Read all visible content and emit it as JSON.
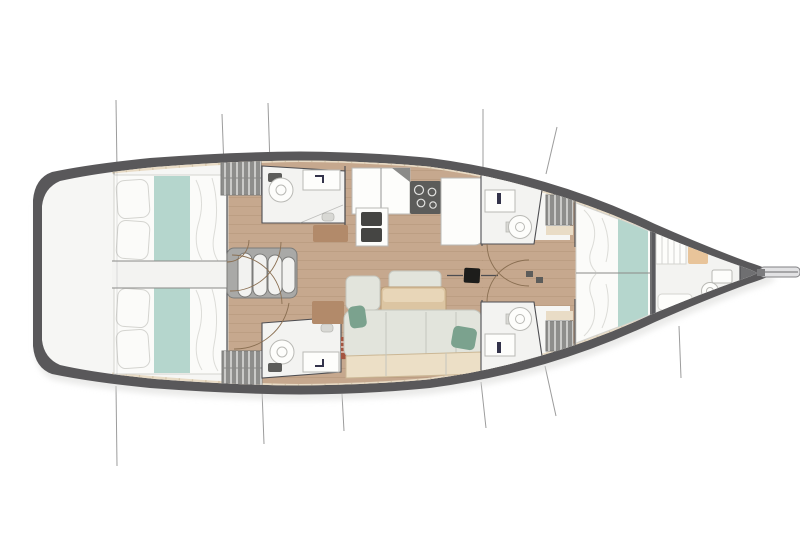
{
  "diagram": {
    "type": "yacht-deck-plan",
    "orientation": "bow-right",
    "regions": [
      "cockpit-stern-platform",
      "aft-cabin-port-double-bed",
      "aft-cabin-starboard-double-bed",
      "stern-corridor",
      "companionway-steps",
      "aft-head-port",
      "aft-head-starboard",
      "hanging-locker-aft-port",
      "hanging-locker-aft-starboard",
      "galley-with-stove-and-sinks",
      "saloon-dinette-table-settee",
      "mast-step",
      "forward-head-port",
      "forward-head-starboard",
      "hanging-locker-forward-port",
      "hanging-locker-forward-starboard",
      "owner-cabin-v-berth",
      "forepeak-crew-cabin",
      "bowsprit",
      "rigging-shroud-lines"
    ]
  },
  "colors": {
    "background": "#ffffff",
    "rigging": "#9c9c9c",
    "shadow": "#d9d9d7",
    "hull": "#59585a",
    "deck": "#f6f6f4",
    "bow_wedge": "#6f6f71",
    "wood_floor": "#c6a88e",
    "wood_plank": "#a98c70",
    "deck_trim": "#e9dcc6",
    "deck_trim_seam": "#cdbb9e",
    "wall": "#4e4e52",
    "bulkhead_light": "#8a8a88",
    "bed_white": "#fbfbf9",
    "bed_outline": "#d4d4d0",
    "runner_teal": "#b5d6cd",
    "pillow_teal": "#7ba28e",
    "fixture_room": "#f3f3f1",
    "fixture_white": "#fdfdfb",
    "fixture_outline": "#b9b9b5",
    "sink_dark": "#454543",
    "stove_dark": "#5c5c5a",
    "steps_outer": "#a9a9a7",
    "steps_inner": "#f2f2f0",
    "steps_edge": "#7c7c7a",
    "locker_gray": "#8e8e8c",
    "locker_stripe": "#d9d9d7",
    "table_wood": "#dcc5a2",
    "table_wood_light": "#e8d6b8",
    "table_edge": "#b89a74",
    "settee": "#e2e4dc",
    "settee_seam": "#c4c6be",
    "bench_cream": "#ecdfc6",
    "bench_edge": "#cbb795",
    "mat_brown": "#b28a6a",
    "mast_black": "#1d1d1b",
    "door_arc": "#8a6f52",
    "ladder_red": "#a4543f",
    "cushion_peach": "#e8c49a",
    "bowsprit_light": "#e2e2e4",
    "bowsprit_outline": "#818184",
    "drain_gray": "#d8d8d4"
  }
}
